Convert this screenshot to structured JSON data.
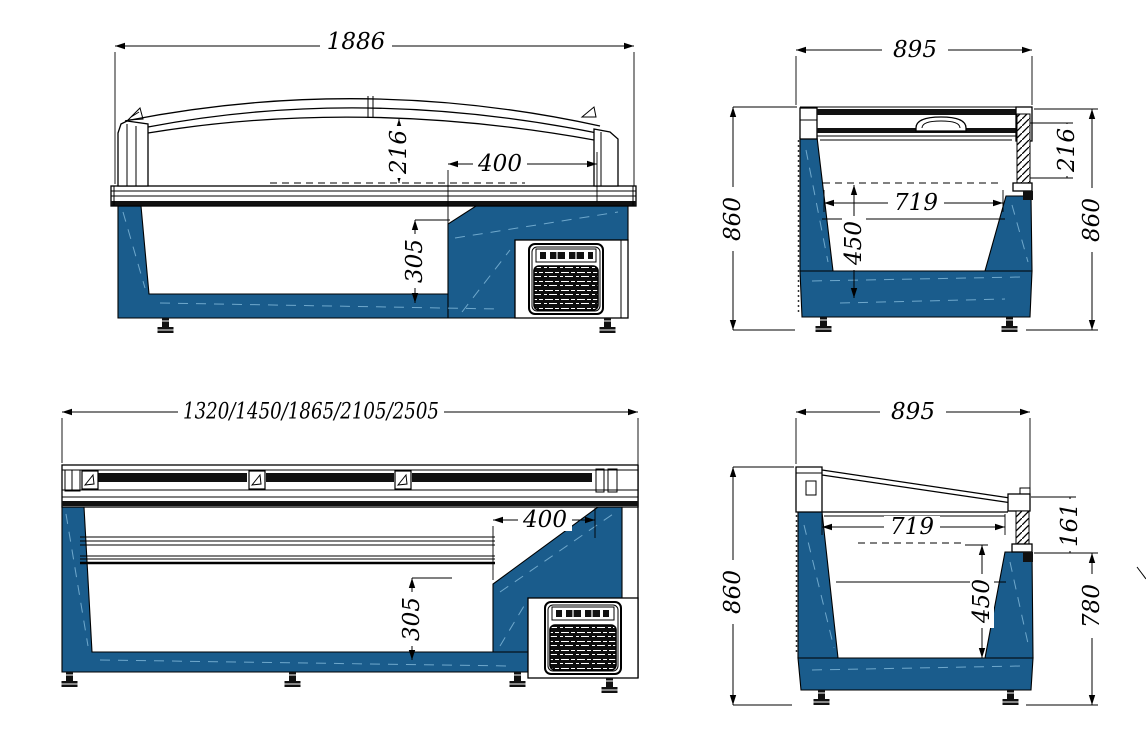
{
  "drawing": {
    "colors": {
      "body_blue": "#1A5C8C",
      "seam_blue": "#6FA8CC",
      "line": "#000000",
      "grille_dark": "#111111",
      "background": "#ffffff"
    },
    "views": {
      "top_left": {
        "dims": {
          "width": "1886",
          "glass_height": "216",
          "machine_width": "400",
          "machine_height": "305"
        }
      },
      "top_right": {
        "dims": {
          "width": "895",
          "height_left": "860",
          "lid_height": "216",
          "inner_width": "719",
          "inner_depth": "450",
          "height_right": "860"
        }
      },
      "bottom_left": {
        "dims": {
          "width_options": "1320/1450/1865/2105/2505",
          "machine_width": "400",
          "machine_height": "305"
        }
      },
      "bottom_right": {
        "dims": {
          "width": "895",
          "height_left": "860",
          "lid_height": "161",
          "inner_width": "719",
          "inner_depth": "450",
          "height_right": "780"
        }
      }
    }
  }
}
